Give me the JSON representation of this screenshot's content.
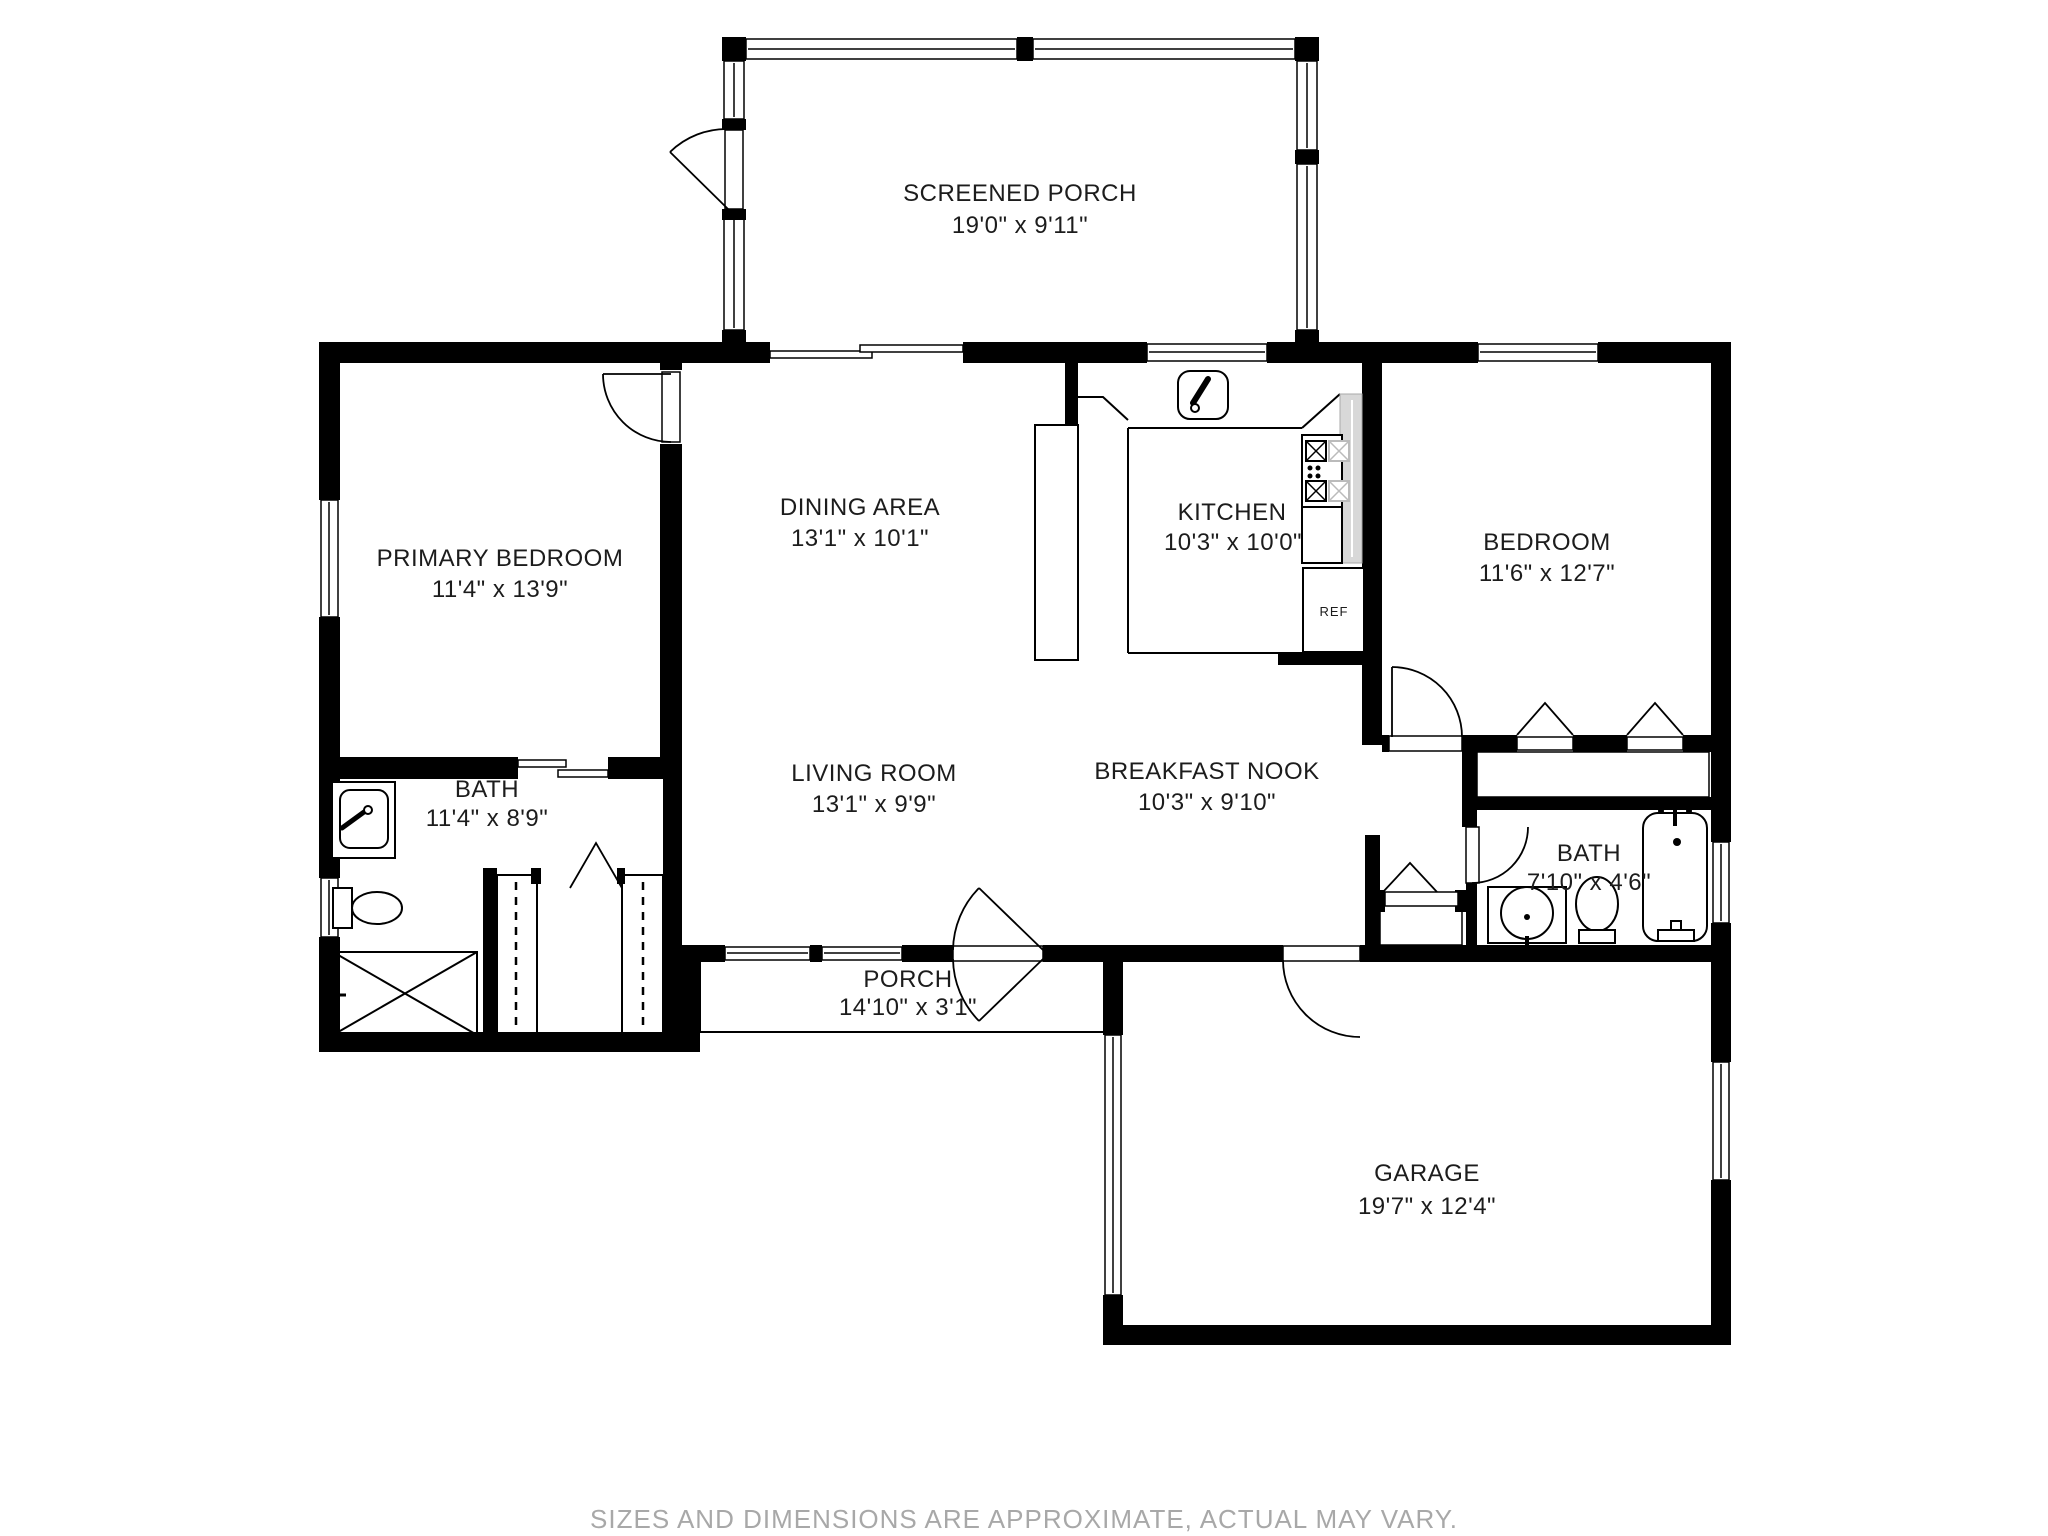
{
  "plan": {
    "rooms": [
      {
        "key": "screened-porch",
        "name": "SCREENED PORCH",
        "dims": "19'0\" x 9'11\""
      },
      {
        "key": "primary-bedroom",
        "name": "PRIMARY BEDROOM",
        "dims": "11'4\" x 13'9\""
      },
      {
        "key": "dining-area",
        "name": "DINING AREA",
        "dims": "13'1\" x 10'1\""
      },
      {
        "key": "kitchen",
        "name": "KITCHEN",
        "dims": "10'3\" x 10'0\""
      },
      {
        "key": "bedroom",
        "name": "BEDROOM",
        "dims": "11'6\" x 12'7\""
      },
      {
        "key": "bath-left",
        "name": "BATH",
        "dims": "11'4\" x 8'9\""
      },
      {
        "key": "living-room",
        "name": "LIVING ROOM",
        "dims": "13'1\" x 9'9\""
      },
      {
        "key": "breakfast-nook",
        "name": "BREAKFAST NOOK",
        "dims": "10'3\" x 9'10\""
      },
      {
        "key": "bath-right",
        "name": "BATH",
        "dims": "7'10\" x 4'6\""
      },
      {
        "key": "porch",
        "name": "PORCH",
        "dims": "14'10\" x 3'1\""
      },
      {
        "key": "garage",
        "name": "GARAGE",
        "dims": "19'7\" x 12'4\""
      }
    ],
    "appliances": {
      "refrigerator": "REF"
    },
    "footer": {
      "disclaimer": "SIZES AND DIMENSIONS ARE APPROXIMATE, ACTUAL MAY VARY."
    },
    "colors": {
      "wall": "#000000",
      "line": "#000000",
      "counter_gray": "#d8d8d8",
      "label": "#1c1c1c",
      "footer_gray": "#a8a8a8",
      "background": "#ffffff"
    }
  }
}
